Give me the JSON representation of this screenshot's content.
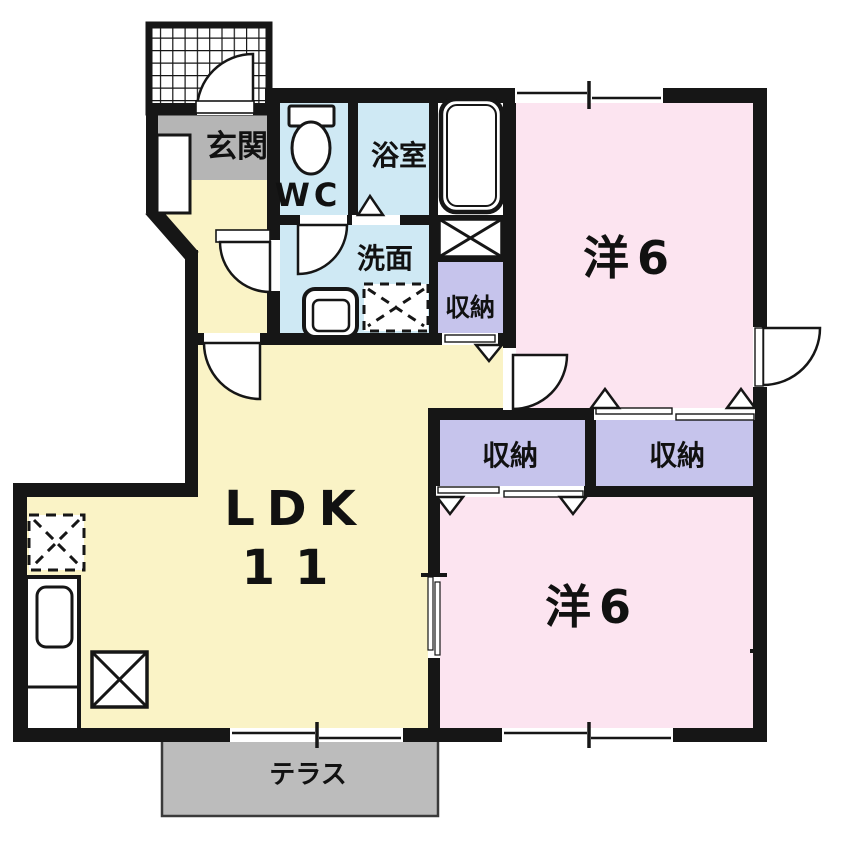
{
  "plan": {
    "labels": {
      "genkan": "玄関",
      "wc": "WC",
      "bath": "浴室",
      "washroom": "洗面",
      "closet_small": "収納",
      "closet_left": "収納",
      "closet_right": "収納",
      "western_top": "洋6",
      "western_bottom": "洋6",
      "ldk_line1": "LDK",
      "ldk_line2": "11",
      "terrace": "テラス"
    },
    "colors": {
      "wall": "#161616",
      "ldk_yellow": "#faf3c6",
      "bedroom_pink": "#fce4f0",
      "water_blue": "#cfe9f4",
      "storage_purple": "#c6c4ec",
      "entry_gray": "#b5b5b5",
      "terrace_gray": "#bcbcbc",
      "fixture_white": "#ffffff",
      "background": "#ffffff"
    }
  }
}
